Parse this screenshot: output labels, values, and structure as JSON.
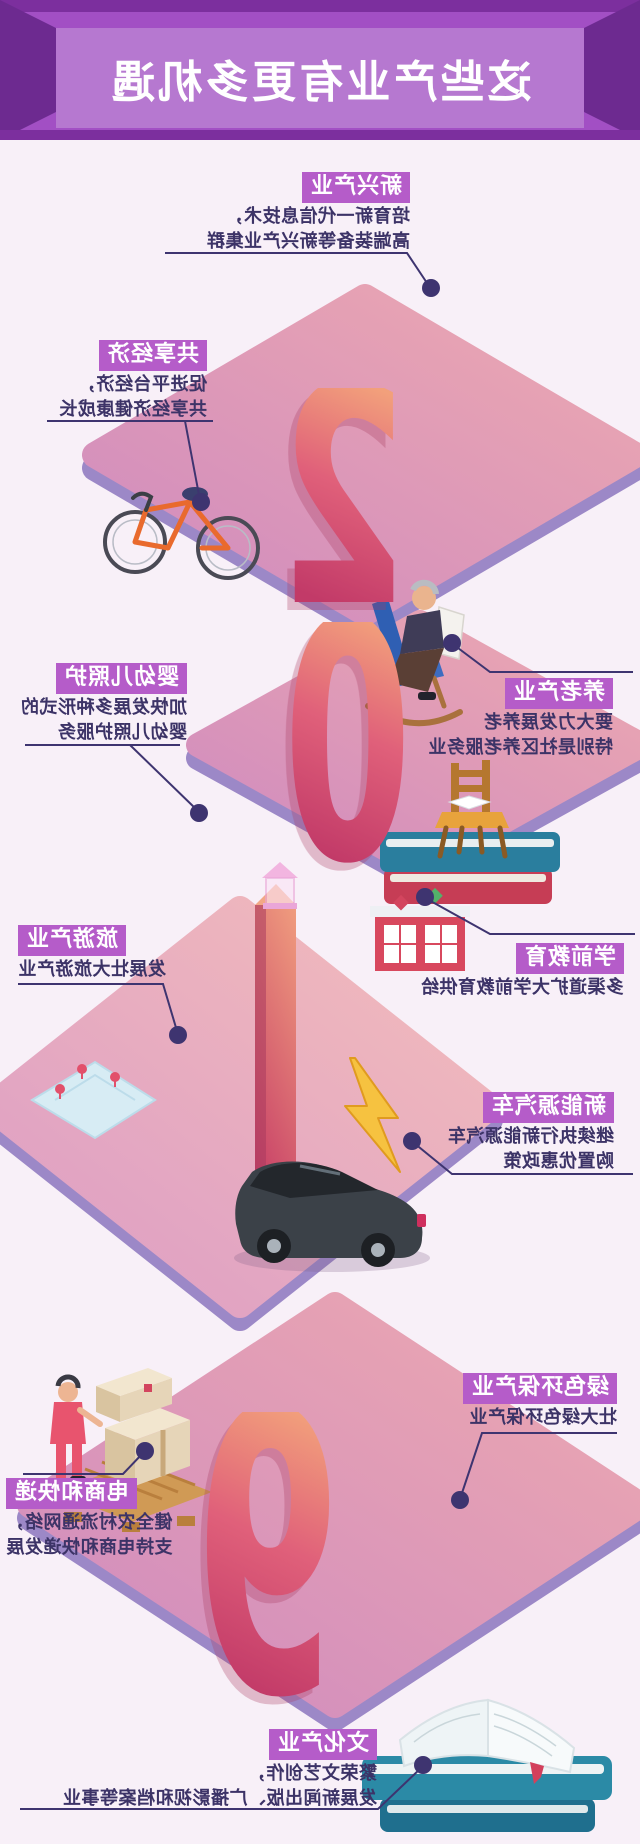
{
  "header": {
    "title": "这些产业有更多机遇",
    "colors": {
      "band": "#a24fc4",
      "bevel": "#6d2a90",
      "strip": "#7c2f9e",
      "panel": "#b678d0"
    }
  },
  "numerals": [
    "2",
    "0",
    "1",
    "9"
  ],
  "sections": [
    {
      "label": "新兴产业",
      "lines": [
        "培育新一代信息技术，",
        "高端装备等新兴产业集群"
      ]
    },
    {
      "label": "共享经济",
      "lines": [
        "促进平台经济，",
        "共享经济健康成长"
      ]
    },
    {
      "label": "养老产业",
      "lines": [
        "要大力发展养老",
        "特别是社区养老服务业"
      ]
    },
    {
      "label": "婴幼儿照护",
      "lines": [
        "加快发展多种形式的",
        "婴幼儿照护服务"
      ]
    },
    {
      "label": "学前教育",
      "lines": [
        "多渠道扩大学前教育供给"
      ]
    },
    {
      "label": "旅游产业",
      "lines": [
        "发展壮大旅游产业"
      ]
    },
    {
      "label": "新能源汽车",
      "lines": [
        "继续执行新能源汽车",
        "购置优惠政策"
      ]
    },
    {
      "label": "绿色环保产业",
      "lines": [
        "壮大绿色环保产业"
      ]
    },
    {
      "label": "电商和快递",
      "lines": [
        "健全农村流通网络，",
        "支持电商和快递发展"
      ]
    },
    {
      "label": "文化产业",
      "lines": [
        "繁荣文艺创作，",
        "发展新闻出版、广播影视和档案等事业"
      ]
    }
  ],
  "colors": {
    "background": "#f8f0f8",
    "accent_label": "#b55cc9",
    "body_text": "#3c3367",
    "leader_line": "#3e3470",
    "platform_top_from": "#eda9b0",
    "platform_top_to": "#cf8abf",
    "platform_side": "#9c88c7",
    "numeral_from": "#f2a07b",
    "numeral_to": "#c23a68"
  },
  "icons": [
    "bicycle-icon",
    "elder-rocking-chair-icon",
    "chair-on-books-icon",
    "school-building-icon",
    "street-lamp-icon",
    "numeral-1-pillar",
    "map-icon",
    "lightning-icon",
    "car-icon",
    "parcel-boxes-icon",
    "delivery-worker-icon",
    "open-book-icon"
  ],
  "note": "image is horizontally mirrored"
}
